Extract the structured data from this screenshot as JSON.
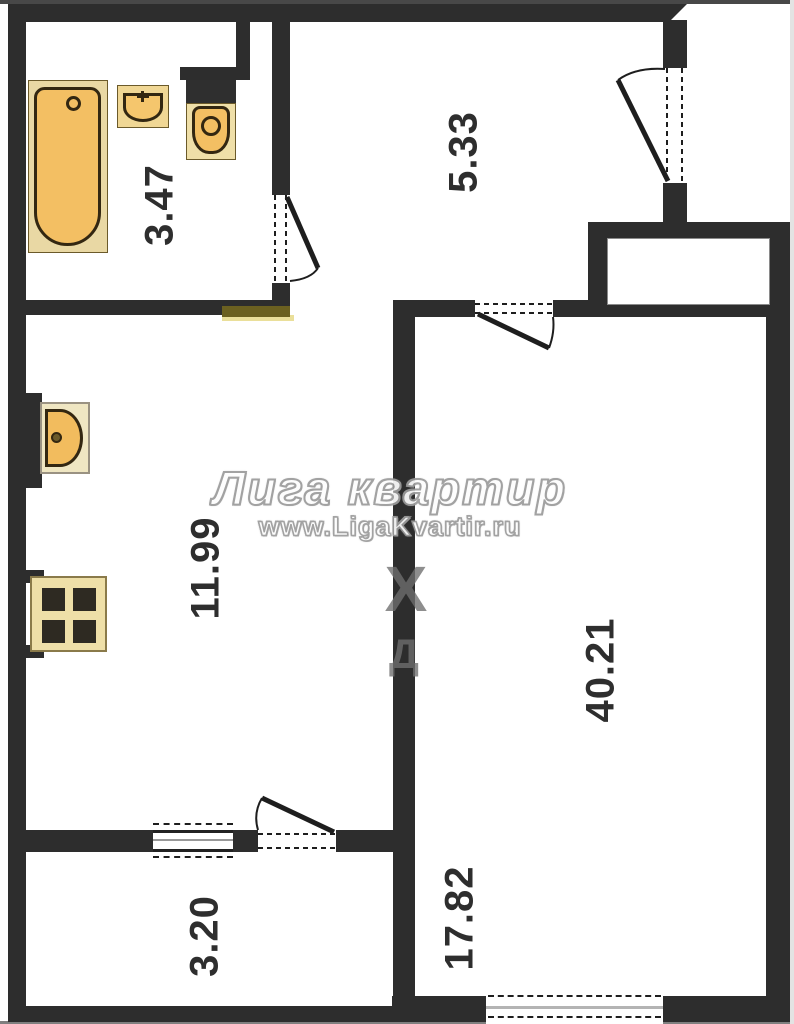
{
  "watermark": {
    "title": "Лига квартир",
    "url": "www.LigaKvartir.ru",
    "glyph_x": "Х",
    "glyph_d": "Д"
  },
  "rooms": {
    "bathroom": {
      "name": "bathroom",
      "label": "3.47"
    },
    "hallway": {
      "name": "hallway",
      "label": "5.33"
    },
    "kitchen": {
      "name": "kitchen",
      "label": "11.99"
    },
    "living_total": {
      "name": "apartment-total",
      "label": "40.21"
    },
    "living": {
      "name": "living-room",
      "label": "17.82"
    },
    "balcony": {
      "name": "balcony",
      "label": "3.20"
    }
  },
  "colors": {
    "wall": "#2d2d2d",
    "fixture_orange": "#f3bf63",
    "fixture_light": "#e9d8a4",
    "strip_olive": "#6b6020",
    "watermark_outline": "#9b9b9b"
  }
}
